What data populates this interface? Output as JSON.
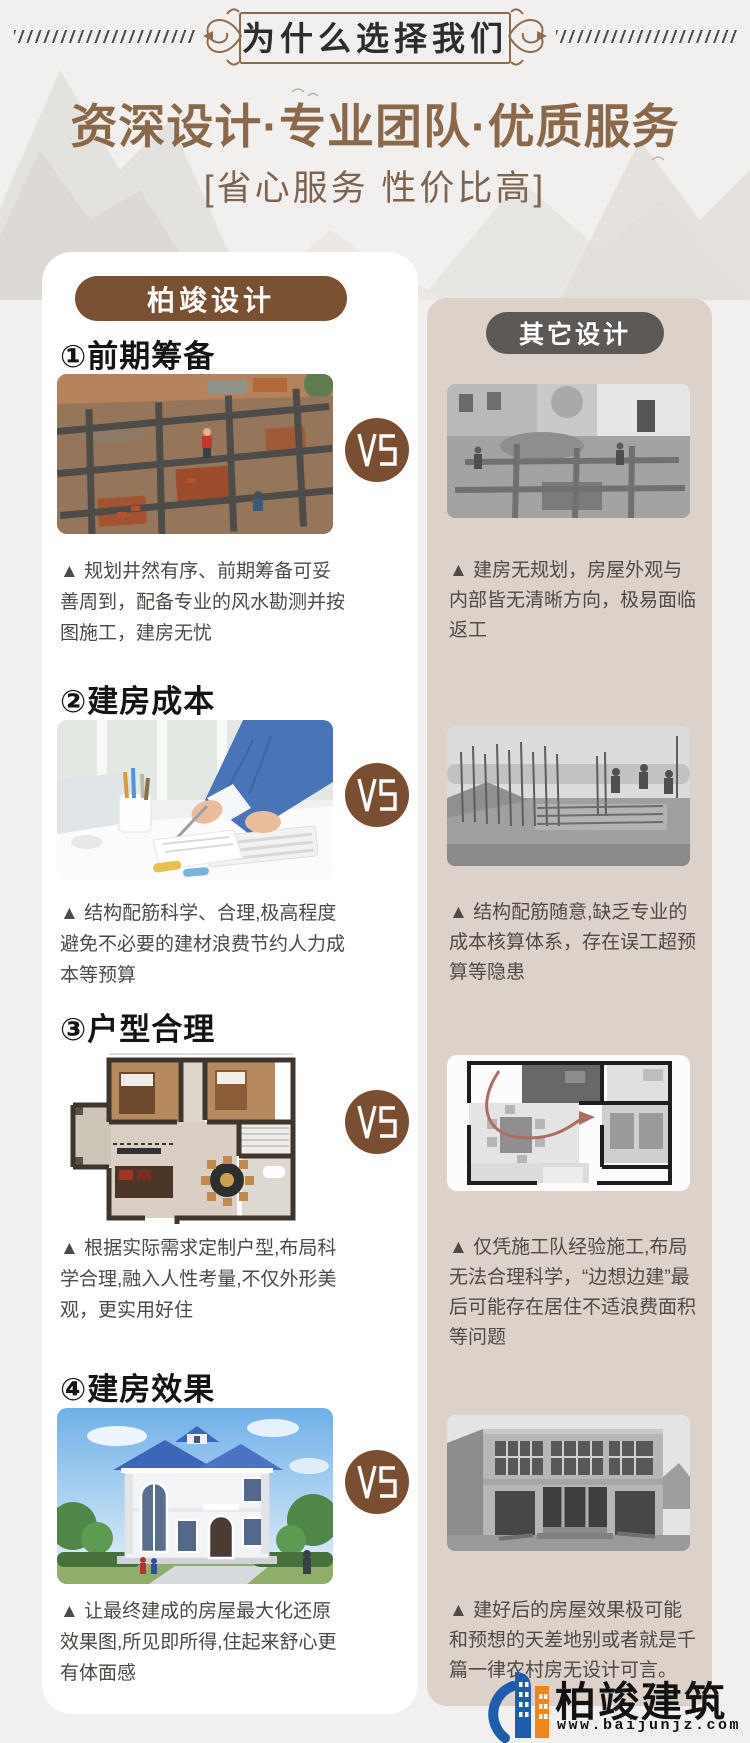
{
  "header": {
    "banner_title": "为什么选择我们",
    "title": "资深设计·专业团队·优质服务",
    "subtitle": "[省心服务 性价比高]"
  },
  "comparison": {
    "left_badge": "柏竣设计",
    "right_badge": "其它设计",
    "vs_label": "VS",
    "sections": [
      {
        "heading": "①前期筹备",
        "left_image": "color-photo-planned-foundation-grid-construction-site",
        "right_image": "grayscale-photo-unplanned-foundation-dig",
        "left_text": "▲ 规划井然有序、前期筹备可妥善周到，配备专业的风水勘测并按图施工，建房无忧",
        "right_text": "▲ 建房无规划，房屋外观与内部皆无清晰方向，极易面临返工"
      },
      {
        "heading": "②建房成本",
        "left_image": "color-photo-designer-calculating-at-desk",
        "right_image": "grayscale-photo-random-rebar-construction",
        "left_text": "▲ 结构配筋科学、合理,极高程度避免不必要的建材浪费节约人力成本等预算",
        "right_text": "▲ 结构配筋随意,缺乏专业的成本核算体系，存在误工超预算等隐患"
      },
      {
        "heading": "③户型合理",
        "left_image": "color-floor-plan-custom-layout",
        "right_image": "grayscale-floor-plan-with-detour-arrow",
        "left_text": "▲ 根据实际需求定制户型,布局科学合理,融入人性考量,不仅外形美观，更实用好住",
        "right_text": "▲ 仅凭施工队经验施工,布局无法合理科学，“边想边建”最后可能存在居住不适浪费面积等问题"
      },
      {
        "heading": "④建房效果",
        "left_image": "color-render-finished-european-villa-blue-roof",
        "right_image": "grayscale-photo-plain-unfinished-concrete-house",
        "left_text": "▲ 让最终建成的房屋最大化还原效果图,所见即所得,住起来舒心更有体面感",
        "right_text": "▲ 建好后的房屋效果极可能和预想的天差地别或者就是千篇一律农村房无设计可言。"
      }
    ]
  },
  "footer": {
    "brand": "柏竣建筑",
    "website": "www.baijunjz.com"
  },
  "colors": {
    "page_background": "#f2f0ee",
    "title_brown": "#8a684a",
    "pill_brown": "#7a5033",
    "pill_gray": "#5b5856",
    "panel_beige": "#dcd2ca",
    "vs_circle_brown": "#7a4e31",
    "logo_blue": "#1e5dad",
    "logo_orange": "#f08519"
  }
}
